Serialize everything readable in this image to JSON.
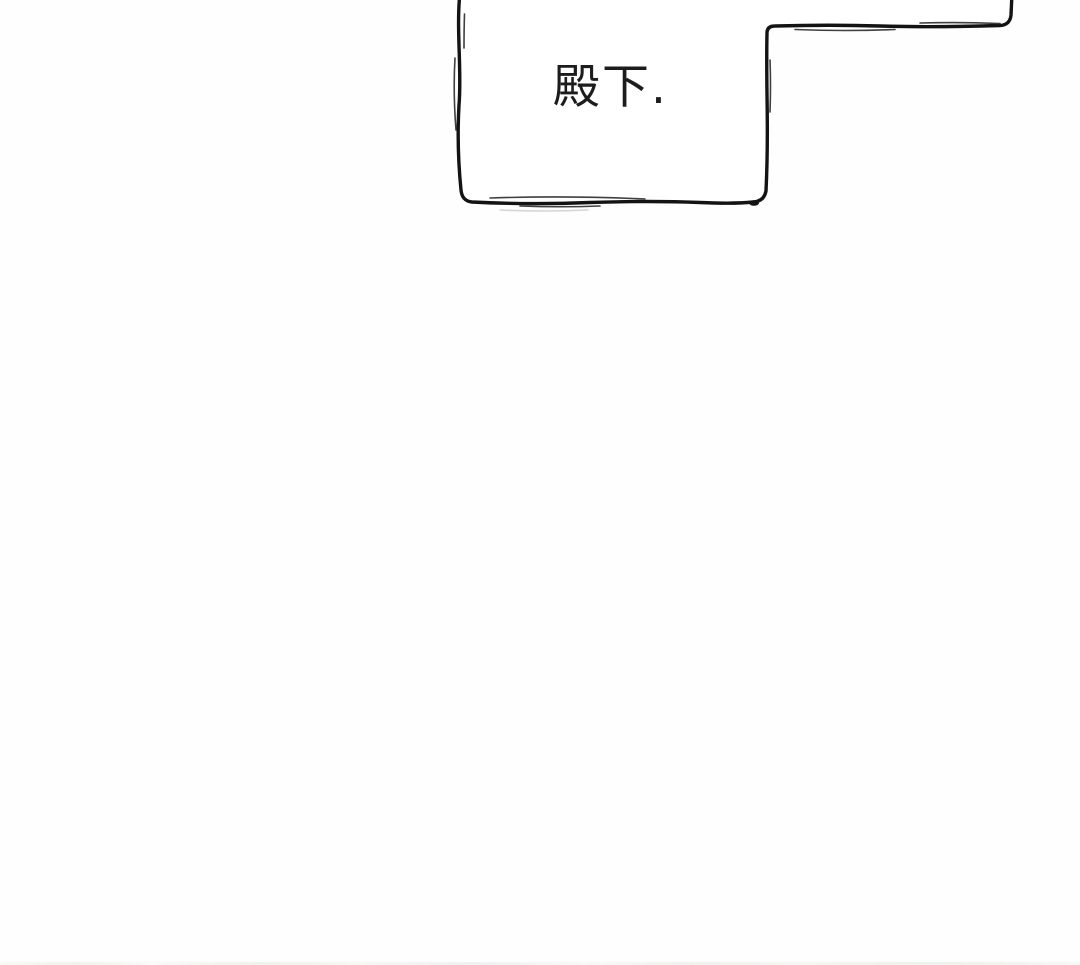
{
  "page": {
    "background_color": "#fefefe"
  },
  "speech_bubble": {
    "text": "殿下.",
    "outline_color": "#131313",
    "fill_color": "#ffffff",
    "sketch_accent_color": "#2b2b2b",
    "smudge_color": "#cbcbcb"
  },
  "next_panel_edge": {
    "colors": [
      "#f4f5f0",
      "#eef0e8",
      "#f7f6f2",
      "#edeff1"
    ]
  }
}
